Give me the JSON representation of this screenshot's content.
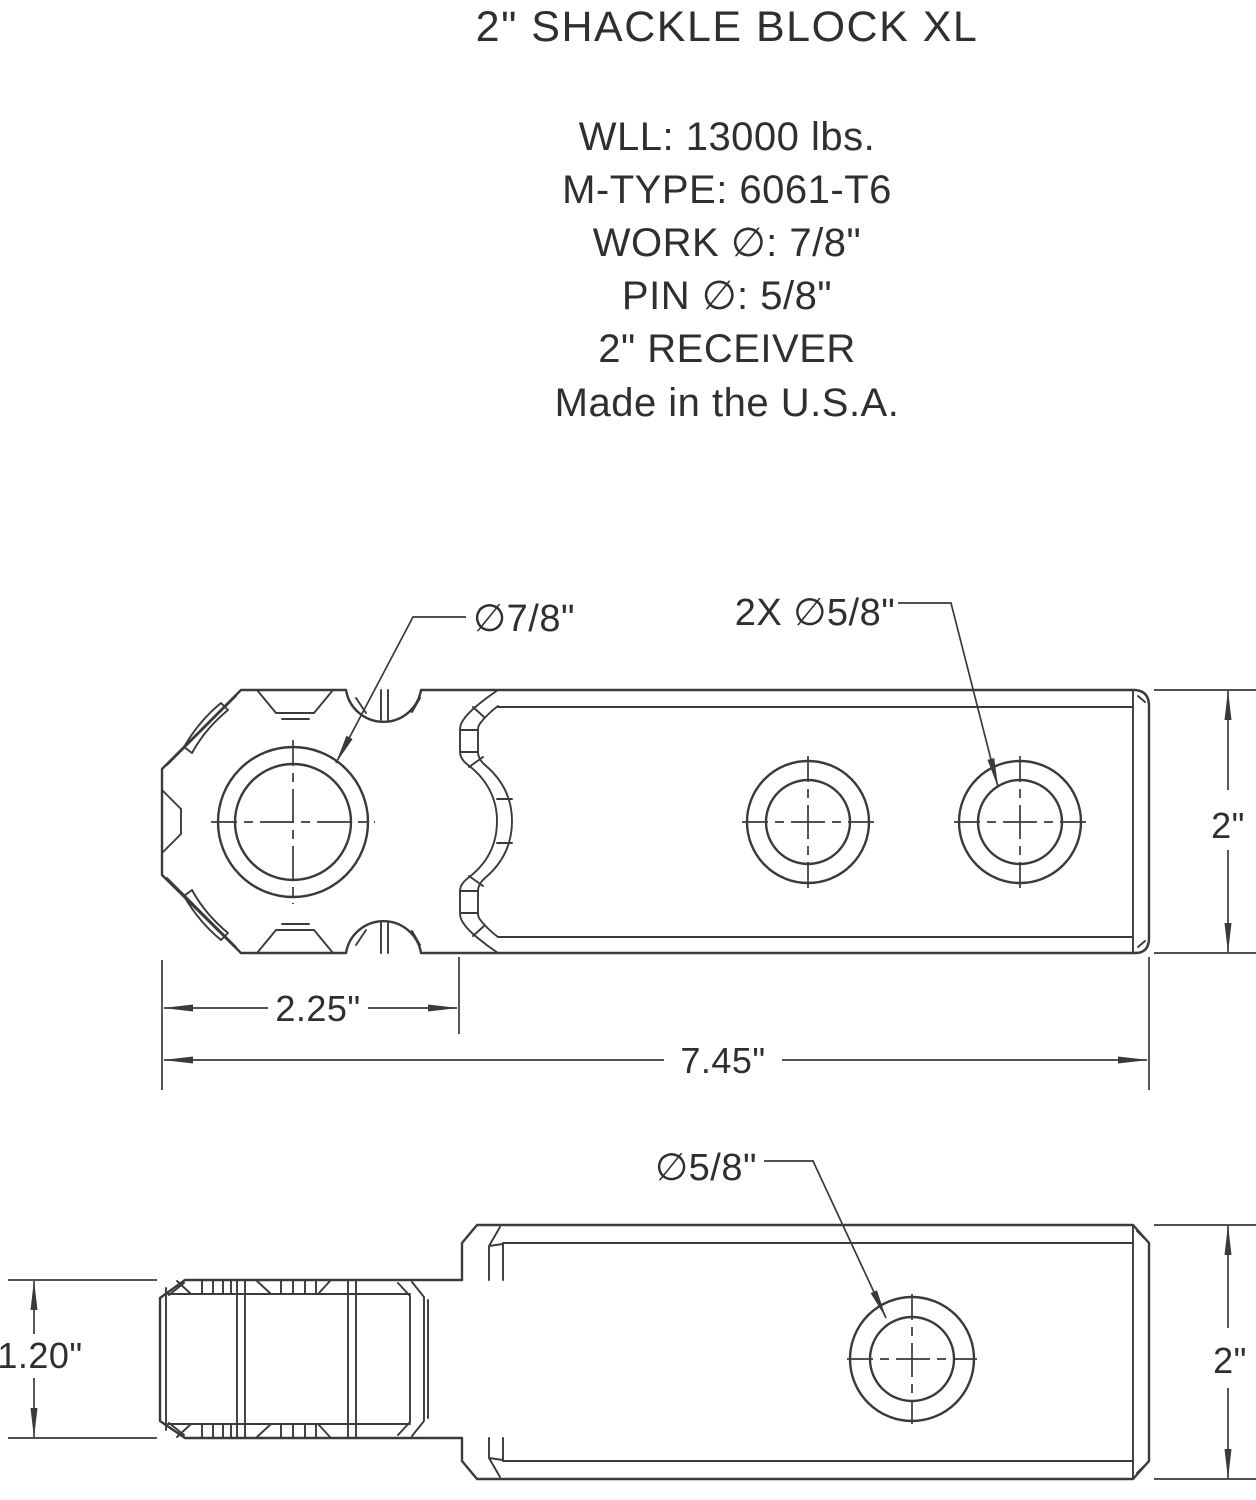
{
  "header": {
    "title": "2\" SHACKLE BLOCK XL",
    "specs": [
      "WLL: 13000 lbs.",
      "M-TYPE: 6061-T6",
      "WORK ∅: 7/8\"",
      "PIN ∅: 5/8\"",
      "2\" RECEIVER",
      "Made in the U.S.A."
    ]
  },
  "top_view": {
    "labels": {
      "main_hole": "∅7/8\"",
      "pin_holes": "2X ∅5/8\"",
      "height": "2\"",
      "head_length": "2.25\"",
      "overall_length": "7.45\""
    }
  },
  "side_view": {
    "labels": {
      "pin_hole": "∅5/8\"",
      "head_height": "1.20\"",
      "height": "2\""
    }
  },
  "colors": {
    "line": "#3a3a3a",
    "text": "#2f2f2f",
    "background": "#ffffff"
  }
}
